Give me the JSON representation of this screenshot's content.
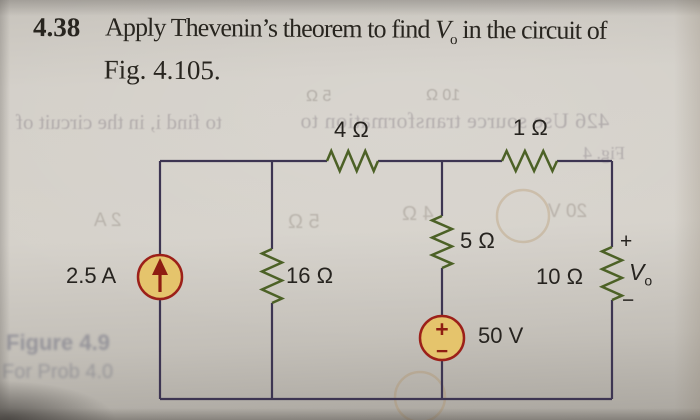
{
  "problem": {
    "number": "4.38",
    "statement_prefix": "Apply Thevenin’s theorem to find ",
    "v_symbol": "V",
    "v_sub": "o",
    "statement_suffix": " in the circuit of",
    "figure_ref": "Fig. 4.105."
  },
  "circuit": {
    "labels": {
      "r_top_left": "4 Ω",
      "r_top_right": "1 Ω",
      "r_middle": "5 Ω",
      "r_left_branch": "16 Ω",
      "r_right_branch": "10 Ω",
      "voltage_source": "50 V",
      "current_source": "2.5 A",
      "vs_plus": "+",
      "vs_minus": "−",
      "vo_plus": "+",
      "vo_symbol": "V",
      "vo_sub": "o",
      "vo_minus": "−"
    },
    "colors": {
      "wire": "#3d3552",
      "resistor": "#4c6126",
      "source_fill": "#e5c46c",
      "source_stroke": "#9c2019",
      "source_mark": "#8e1d12",
      "label_text": "#26231f"
    }
  },
  "ghosts": {
    "band_left": "to find i, in the circuit of",
    "band_right": "426  Use source transformation to",
    "fig": "Fig. 4",
    "top_r5": "5 Ω",
    "top_r10": "10 Ω",
    "r5": "5 Ω",
    "r4": "4 Ω",
    "v20": "20 V",
    "i2": "2 A",
    "caption1": "Figure 4.9",
    "caption2": "For Prob 4.0"
  }
}
